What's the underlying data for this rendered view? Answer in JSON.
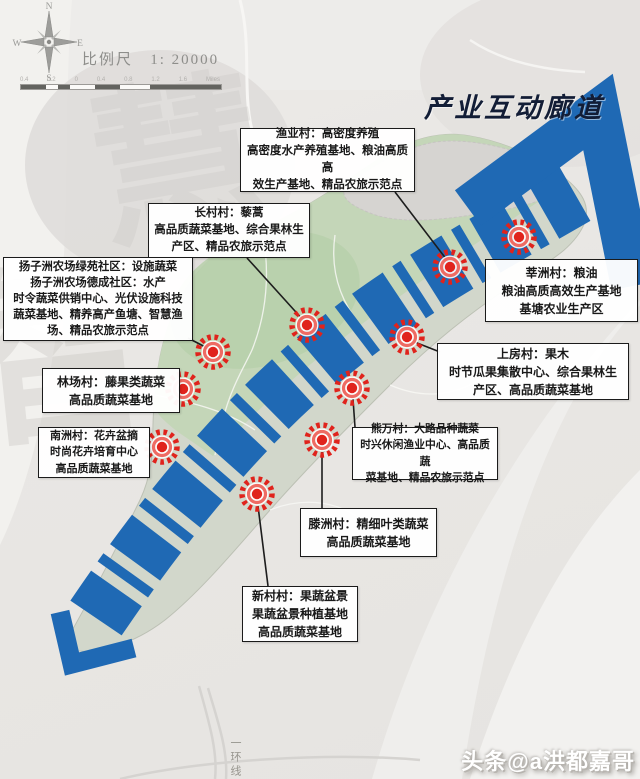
{
  "title": "产业互动廊道",
  "compass": {
    "n": "N",
    "s": "S",
    "e": "E",
    "w": "W"
  },
  "scale": {
    "label": "比例尺",
    "ratio": "1: 20000",
    "ticks": [
      "0.4",
      "0.2",
      "0",
      "0.4",
      "0.8",
      "1.2",
      "1.6"
    ],
    "unit": "Miles"
  },
  "road_label": "一环线",
  "watermark": {
    "glyph1": "智",
    "glyph2": "慧"
  },
  "credit": "头条@a洪都嘉哥",
  "colors": {
    "corridor_blue": "#1f69b4",
    "marker_red": "#e0231c",
    "island_green": "#c4d6b8",
    "title_navy": "#121d36"
  },
  "callouts": [
    {
      "village": "渔业村",
      "lines": [
        "渔业村：高密度养殖",
        "高密度水产养殖基地、粮油高质高",
        "效生产基地、精品农旅示范点"
      ]
    },
    {
      "village": "长村村",
      "lines": [
        "长村村：藜蒿",
        "高品质蔬菜基地、综合果林生",
        "产区、精品农旅示范点"
      ]
    },
    {
      "village": "扬子洲农场社区",
      "lines": [
        "扬子洲农场绿苑社区：设施蔬菜",
        "扬子洲农场德成社区：水产",
        "时令蔬菜供销中心、光伏设施科技",
        "蔬菜基地、精养高产鱼塘、智慧渔",
        "场、精品农旅示范点"
      ]
    },
    {
      "village": "莘洲村",
      "lines": [
        "莘洲村：粮油",
        "粮油高质高效生产基地",
        "基塘农业生产区"
      ]
    },
    {
      "village": "上房村",
      "lines": [
        "上房村：果木",
        "时节瓜果集散中心、综合果林生",
        "产区、高品质蔬菜基地"
      ]
    },
    {
      "village": "林场村",
      "lines": [
        "林场村：藤果类蔬菜",
        "高品质蔬菜基地"
      ]
    },
    {
      "village": "南洲村",
      "lines": [
        "南洲村：花卉盆摘",
        "时尚花卉培育中心",
        "高品质蔬菜基地"
      ]
    },
    {
      "village": "熊万村",
      "lines": [
        "熊万村：大路品种蔬菜",
        "时兴休闲渔业中心、高品质蔬",
        "菜基地、精品农旅示范点"
      ]
    },
    {
      "village": "滕洲村",
      "lines": [
        "滕洲村：精细叶类蔬菜",
        "高品质蔬菜基地"
      ]
    },
    {
      "village": "新村村",
      "lines": [
        "新村村：果蔬盆景",
        "果蔬盆景种植基地",
        "高品质蔬菜基地"
      ]
    }
  ]
}
